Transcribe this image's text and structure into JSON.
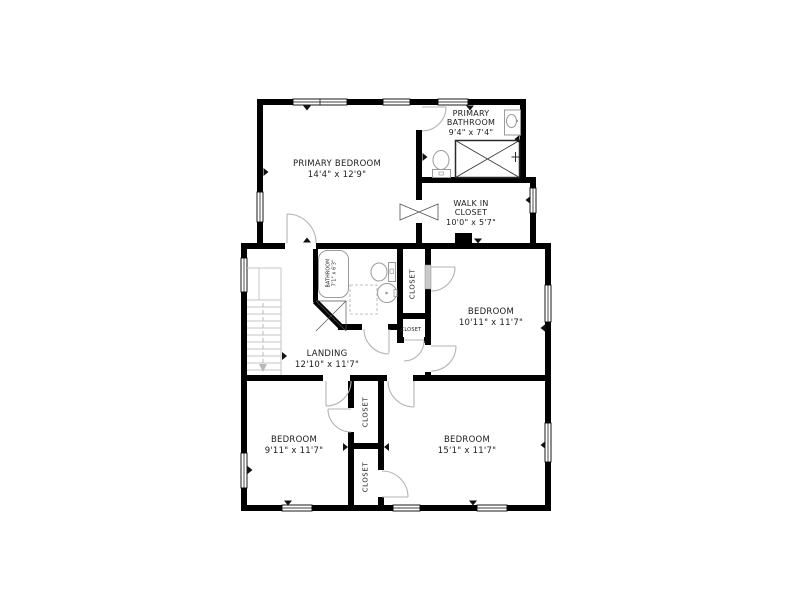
{
  "plan": {
    "rooms": {
      "primary_bedroom": {
        "name": "PRIMARY BEDROOM",
        "dims": "14'4\" x 12'9\""
      },
      "primary_bathroom": {
        "name_line1": "PRIMARY",
        "name_line2": "BATHROOM",
        "dims": "9'4\" x 7'4\""
      },
      "walk_in_closet": {
        "name_line1": "WALK IN",
        "name_line2": "CLOSET",
        "dims": "10'0\" x 5'7\""
      },
      "bathroom": {
        "name": "BATHROOM",
        "dims": "7'1\" x 6'3\""
      },
      "bedroom_middle": {
        "name": "BEDROOM",
        "dims": "10'11\" x 11'7\""
      },
      "landing": {
        "name": "LANDING",
        "dims": "12'10\" x 11'7\""
      },
      "hall_closet": {
        "name": "CLOSET"
      },
      "hall_closet_small": {
        "name": "CLOSET"
      },
      "bedroom_bottom_left": {
        "name": "BEDROOM",
        "dims": "9'11\" x 11'7\""
      },
      "bedroom_bottom_right": {
        "name": "BEDROOM",
        "dims": "15'1\" x 11'7\""
      },
      "closet_upper": {
        "name": "CLOSET"
      },
      "closet_lower": {
        "name": "CLOSET"
      }
    },
    "colors": {
      "wall": "#000000",
      "fixture_outline": "#9a9a9a",
      "door": "#b3b3b3",
      "stair": "#c6c6c6",
      "text": "#1c1c1c",
      "background": "#ffffff"
    },
    "icons": {
      "bathtub": "bathtub-icon",
      "toilet": "toilet-icon",
      "sink": "sink-icon",
      "shower": "shower-icon",
      "stairs": "stairs-icon",
      "window": "window-icon",
      "door_swing": "door-swing-icon",
      "opening_arrow": "opening-arrow-icon"
    }
  }
}
